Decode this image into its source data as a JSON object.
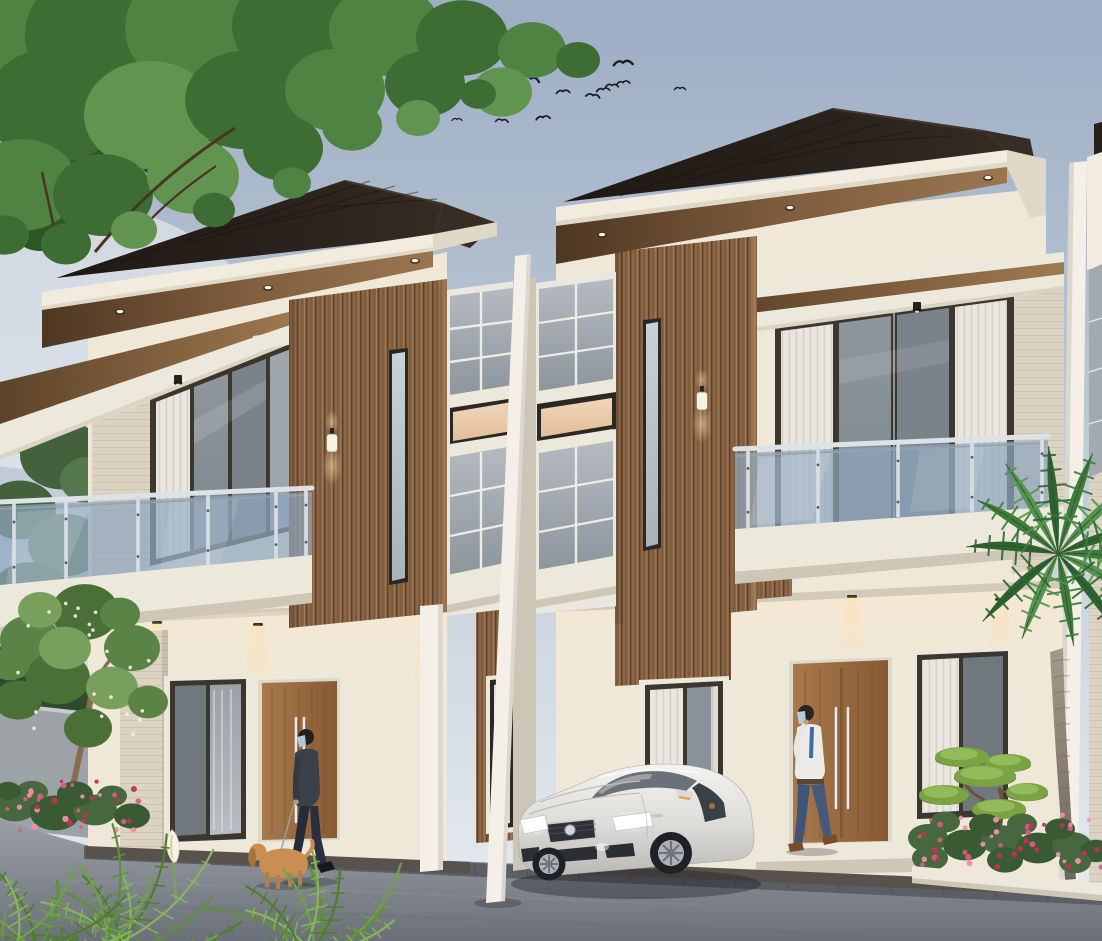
{
  "scene": {
    "description": "Dusk architectural rendering of a modern two-storey duplex (two mirrored units) with dark hip roofs, wood slat accent columns, glass balconies, a white sedan parked in front, a man walking a dog, a man at the right door, palm tree, bonsai and flower beds",
    "setting": "dusk",
    "units": 2
  },
  "palette": {
    "sky_top": "#9DADC4",
    "sky_mid": "#B6C2D2",
    "sky_low": "#CDD6E0",
    "sky_bottom": "#E9EDF2",
    "roof": "#261F1A",
    "roof_side": "#382D25",
    "fascia": "#F2ECDE",
    "fascia_shade": "#E0D8C6",
    "soffit_dark": "#4E3722",
    "soffit_mid": "#7E5C3D",
    "soffit_light": "#9A7650",
    "wall_cream": "#EFE8D9",
    "wall_warm": "#F6EDDC",
    "stone": "#DCD3C2",
    "stone_line": "#C9BFAC",
    "slat": "#8A6546",
    "slat_dark": "#5A3F2A",
    "slat_light": "#9C7650",
    "frame_dark": "#3B372F",
    "frame_black": "#2B2823",
    "glass_dark": "#70787E",
    "glass_mid": "#8A9298",
    "glass_light": "#A3AAAF",
    "curtain": "#EAE7E0",
    "peach_window": "#E9CBA8",
    "rail_glass": "#8FA6BE",
    "chrome": "#DDE2E7",
    "slab_white": "#EDE8DC",
    "slab_shadow": "#CFC7B6",
    "door_wood": "#A8794B",
    "door_wood_dark": "#875A33",
    "door_grain": "#5E3E22",
    "pillar_white": "#F4F0E7",
    "road_light": "#9B9EA6",
    "road_dark": "#6B6F77",
    "road_paver": "#5B5E64",
    "plinth": "#57534C",
    "gray_wall": "#9DA2A6",
    "g1": "#3E6D33",
    "g2": "#4F8341",
    "g3": "#61954F",
    "gd": "#2E5527",
    "bgA": "#55794E",
    "bgB": "#42613C",
    "bgC": "#60855A",
    "hedge": "#2F4A30",
    "fern1": "#4F7D2F",
    "fern2": "#6FA04A",
    "fern3": "#85B55C",
    "fern4": "#5E8F3C",
    "flower_pink": "#D95C80",
    "flower_deep": "#C13352",
    "flower_light": "#F08FA8",
    "flg1": "#3A5A34",
    "flg2": "#47683F",
    "palm1": "#2F6330",
    "palm2": "#3F7C3C",
    "palm3": "#559350",
    "p1": "#5B8345",
    "p2": "#4A7038",
    "p3": "#78A05C",
    "trunk_brown": "#8A6B4D",
    "bonsai": "#7BA344",
    "bonsai_hi": "#95BE5C",
    "bonsai_sh": "#5E8030",
    "car_body": "#E8E6E2",
    "car_dark": "#2E3136",
    "headlight": "#FFFFFF",
    "suit": "#3B4049",
    "suit_dark": "#262B38",
    "shirt": "#EDEBE7",
    "pants_blue": "#3F5578",
    "mask": "#AFC6D9",
    "skin": "#C89A7E",
    "hair": "#242019",
    "shoe_brown": "#7A4B2E",
    "dog_tan": "#C98E52",
    "dog_dark": "#A9733C",
    "bird": "#1A1D21",
    "lamp_warm": "#FFE2B0"
  },
  "birds": {
    "count": 16,
    "positions": [
      [
        472,
        67,
        1.2,
        -6
      ],
      [
        520,
        70,
        1.3,
        4
      ],
      [
        531,
        78,
        1.25,
        12
      ],
      [
        623,
        62,
        1.35,
        -4
      ],
      [
        473,
        90,
        1.1,
        -10
      ],
      [
        497,
        92,
        1.0,
        6
      ],
      [
        482,
        100,
        1.0,
        0
      ],
      [
        563,
        91,
        0.95,
        -4
      ],
      [
        593,
        95,
        1.0,
        8
      ],
      [
        603,
        89,
        0.95,
        -6
      ],
      [
        612,
        85,
        0.9,
        0
      ],
      [
        623,
        82,
        0.95,
        -8
      ],
      [
        502,
        120,
        0.9,
        4
      ],
      [
        543,
        117,
        1.0,
        -6
      ],
      [
        457,
        119,
        0.7,
        0
      ],
      [
        680,
        88,
        0.8,
        0
      ]
    ]
  },
  "lights": {
    "left_soffit_downlights": [
      [
        120,
        312
      ],
      [
        268,
        288
      ],
      [
        415,
        261
      ]
    ],
    "right_soffit_downlights": [
      [
        602,
        235
      ],
      [
        790,
        208
      ],
      [
        988,
        178
      ]
    ],
    "left_canopy_cylinder": [
      178,
      384
    ],
    "right_canopy_cylinder": [
      917,
      311
    ],
    "left_porch_downlights": [
      [
        157,
        623
      ],
      [
        258,
        625
      ],
      [
        428,
        618
      ]
    ],
    "right_porch_downlights": [
      [
        695,
        610
      ],
      [
        852,
        597
      ],
      [
        1000,
        600
      ]
    ],
    "left_wall_sconce": [
      332,
      436
    ],
    "right_wall_sconce": [
      702,
      394
    ]
  },
  "railings": {
    "left": {
      "posts": [
        14,
        66,
        138,
        208,
        276,
        306
      ],
      "x0": 0,
      "topY": 502,
      "topM": -0.0449,
      "botY": 585,
      "botM": -0.0962
    },
    "right": {
      "posts": [
        748,
        818,
        898,
        972,
        1042
      ],
      "x0": 735,
      "topY": 449,
      "topM": -0.0415,
      "botY": 529,
      "botM": -0.0735
    }
  },
  "doors": {
    "left_handles": {
      "x": [
        296,
        304
      ],
      "y1": 718,
      "y2": 822
    },
    "right_handles": {
      "x": [
        836,
        848
      ],
      "y1": 708,
      "y2": 808
    }
  },
  "paver": {
    "x0": 110,
    "x1": 1080,
    "step": 52,
    "yBase": 847,
    "slope": 0.0435,
    "xRef": 85,
    "len": 11
  },
  "vegetation": {
    "canopy_blobs": [
      [
        80,
        160,
        40,
        "gd"
      ],
      [
        178,
        148,
        44,
        "gd"
      ],
      [
        268,
        118,
        36,
        "gd"
      ],
      [
        40,
        228,
        28,
        "gd"
      ],
      [
        120,
        90,
        50,
        "gd"
      ],
      [
        25,
        25,
        85,
        "g2"
      ],
      [
        110,
        35,
        85,
        "g1"
      ],
      [
        205,
        28,
        80,
        "g2"
      ],
      [
        298,
        26,
        66,
        "g1"
      ],
      [
        385,
        30,
        56,
        "g2"
      ],
      [
        462,
        38,
        46,
        "g1"
      ],
      [
        532,
        50,
        34,
        "g2"
      ],
      [
        578,
        60,
        22,
        "g1"
      ],
      [
        55,
        105,
        70,
        "g1"
      ],
      [
        150,
        115,
        66,
        "g3"
      ],
      [
        245,
        100,
        60,
        "g1"
      ],
      [
        335,
        90,
        50,
        "g2"
      ],
      [
        425,
        84,
        40,
        "g1"
      ],
      [
        502,
        92,
        30,
        "g3"
      ],
      [
        22,
        185,
        56,
        "g2"
      ],
      [
        103,
        195,
        50,
        "g1"
      ],
      [
        193,
        176,
        46,
        "g3"
      ],
      [
        283,
        148,
        40,
        "g1"
      ]
    ],
    "canopy_fringe": [
      [
        66,
        244,
        25,
        "g1"
      ],
      [
        134,
        230,
        23,
        "g3"
      ],
      [
        214,
        210,
        21,
        "g1"
      ],
      [
        292,
        183,
        19,
        "g2"
      ],
      [
        418,
        118,
        22,
        "g3"
      ],
      [
        478,
        94,
        18,
        "g1"
      ],
      [
        5,
        235,
        24,
        "g1"
      ],
      [
        352,
        126,
        30,
        "g2"
      ]
    ],
    "bg_trees": [
      [
        18,
        420,
        40,
        "bgA"
      ],
      [
        62,
        455,
        42,
        "bgB"
      ],
      [
        20,
        510,
        36,
        "bgB"
      ],
      [
        66,
        545,
        38,
        "bgA"
      ],
      [
        30,
        595,
        40,
        "bgB"
      ],
      [
        70,
        628,
        34,
        "bgC"
      ],
      [
        24,
        664,
        32,
        "bgB"
      ],
      [
        60,
        690,
        28,
        "bgA"
      ],
      [
        88,
        600,
        26,
        "bgB"
      ],
      [
        88,
        480,
        28,
        "bgA"
      ]
    ],
    "hedge": [
      [
        12,
        700,
        30,
        "hedge"
      ],
      [
        50,
        712,
        32,
        "hedge"
      ],
      [
        86,
        706,
        26,
        "hedge"
      ],
      [
        30,
        728,
        26,
        "hedge"
      ],
      [
        70,
        732,
        24,
        "hedge"
      ]
    ],
    "plumeria_blobs": [
      [
        30,
        640,
        30,
        "p1"
      ],
      [
        85,
        612,
        34,
        "p2"
      ],
      [
        132,
        648,
        28,
        "p1"
      ],
      [
        58,
        678,
        32,
        "p2"
      ],
      [
        112,
        688,
        26,
        "p3"
      ],
      [
        18,
        700,
        24,
        "p2"
      ],
      [
        148,
        702,
        20,
        "p1"
      ],
      [
        88,
        728,
        24,
        "p2"
      ],
      [
        40,
        610,
        22,
        "p3"
      ],
      [
        120,
        614,
        20,
        "p1"
      ],
      [
        10,
        664,
        20,
        "p1"
      ],
      [
        65,
        648,
        26,
        "p3"
      ]
    ],
    "plumeria_dots": {
      "x": 15,
      "y": 600,
      "w": 135,
      "h": 135,
      "count": 22
    },
    "flower_left": {
      "greens": [
        [
          15,
          806,
          22
        ],
        [
          55,
          813,
          25
        ],
        [
          95,
          810,
          22
        ],
        [
          132,
          816,
          18
        ],
        [
          32,
          792,
          16
        ],
        [
          75,
          794,
          18
        ],
        [
          112,
          796,
          15
        ],
        [
          8,
          791,
          13
        ]
      ],
      "scatter": {
        "x": 2,
        "y": 779,
        "w": 138,
        "h": 52,
        "count": 34,
        "colors": [
          "flower_pink",
          "flower_deep",
          "flower_light"
        ]
      }
    },
    "flower_right": {
      "greens": [
        [
          928,
          838,
          20
        ],
        [
          965,
          845,
          22
        ],
        [
          1002,
          840,
          21
        ],
        [
          1038,
          848,
          22
        ],
        [
          1072,
          846,
          20
        ],
        [
          1096,
          851,
          16
        ],
        [
          945,
          822,
          15
        ],
        [
          985,
          825,
          16
        ],
        [
          1022,
          824,
          15
        ],
        [
          1060,
          829,
          15
        ],
        [
          930,
          858,
          18
        ],
        [
          1005,
          860,
          18
        ],
        [
          1075,
          862,
          16
        ]
      ],
      "scatter": {
        "x": 918,
        "y": 812,
        "w": 184,
        "h": 56,
        "count": 44,
        "colors": [
          "flower_deep",
          "flower_pink",
          "flower_light"
        ]
      }
    },
    "bonsai_pads": [
      [
        962,
        757,
        27,
        10
      ],
      [
        1008,
        763,
        23,
        9
      ],
      [
        985,
        776,
        31,
        11
      ],
      [
        944,
        795,
        25,
        10
      ],
      [
        1027,
        792,
        21,
        9
      ],
      [
        999,
        809,
        27,
        10
      ]
    ],
    "palm": {
      "center": [
        1058,
        554
      ],
      "fronds": [
        [
          -165,
          95
        ],
        [
          -140,
          105
        ],
        [
          -118,
          112
        ],
        [
          -95,
          110
        ],
        [
          -72,
          112
        ],
        [
          -48,
          108
        ],
        [
          -25,
          100
        ],
        [
          -5,
          92
        ],
        [
          20,
          88
        ],
        [
          48,
          95
        ],
        [
          80,
          90
        ],
        [
          115,
          85
        ],
        [
          145,
          92
        ]
      ]
    },
    "ferns": [
      {
        "base": [
          115,
          950
        ],
        "count": 14,
        "lmin": 80,
        "lmax": 150,
        "tones": [
          "fern1",
          "fern2",
          "fern3",
          "fern4"
        ]
      },
      {
        "base": [
          315,
          952
        ],
        "count": 12,
        "lmin": 70,
        "lmax": 130,
        "tones": [
          "fern2",
          "fern4",
          "fern3",
          "fern1"
        ]
      },
      {
        "base": [
          30,
          945
        ],
        "count": 8,
        "lmin": 60,
        "lmax": 110,
        "tones": [
          "fern4",
          "fern2",
          "fern1",
          "fern3"
        ]
      }
    ]
  },
  "car": {
    "type": "sedan",
    "color": "white",
    "headlights_on": true,
    "badge": "round-chrome"
  },
  "people": [
    {
      "id": "man-walking-dog",
      "clothes": "dark suit",
      "accessory": "face mask",
      "pet": "tan dog on leash"
    },
    {
      "id": "man-at-door",
      "clothes": "white shirt, blue tie, blue trousers",
      "accessory": "face mask"
    }
  ]
}
